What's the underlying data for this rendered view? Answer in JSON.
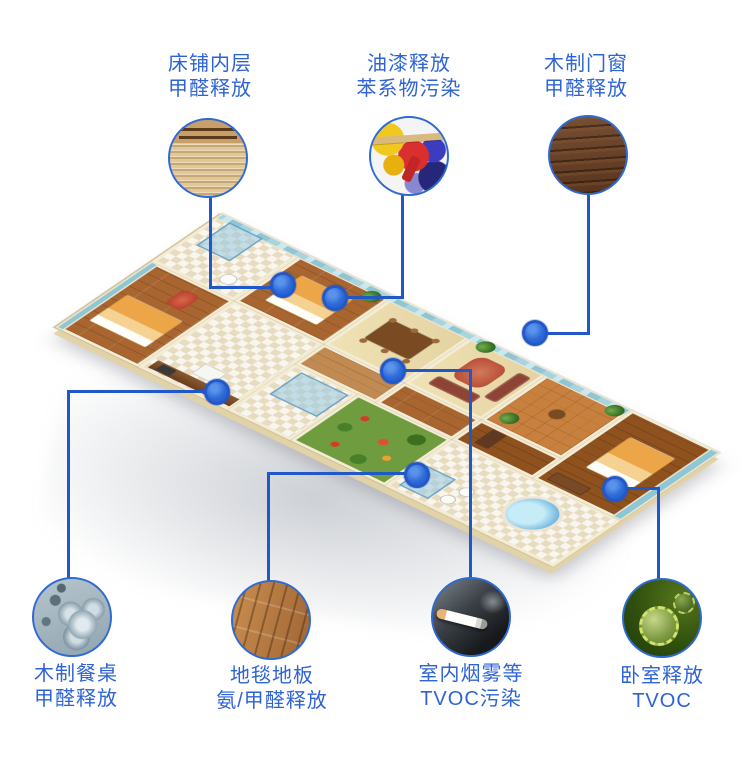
{
  "diagram": {
    "subject": "3d-apartment-indoor-air-pollution-sources",
    "colors": {
      "label_text": "#2e63d6",
      "connector_line": "#2058c8",
      "hotspot_dot": "#2e6bd8",
      "circle_border": "#2f6ad2",
      "background": "#ffffff"
    }
  },
  "callouts": [
    {
      "id": "bed-inner-layer",
      "line1": "床铺内层",
      "line2": "甲醛释放",
      "thumb": "bed-slats-photo"
    },
    {
      "id": "paint-release",
      "line1": "油漆释放",
      "line2": "苯系物污染",
      "thumb": "paint-cans-photo"
    },
    {
      "id": "wooden-doors-windows",
      "line1": "木制门窗",
      "line2": "甲醛释放",
      "thumb": "dark-wood-grain-photo"
    },
    {
      "id": "wooden-dining-table",
      "line1": "木制餐桌",
      "line2": "甲醛释放",
      "thumb": "molecule-spheres-photo"
    },
    {
      "id": "carpet-floor",
      "line1": "地毯地板",
      "line2": "氨/甲醛释放",
      "thumb": "wood-floor-photo"
    },
    {
      "id": "indoor-smoke",
      "line1": "室内烟雾等",
      "line2": "TVOC污染",
      "thumb": "cigarette-photo"
    },
    {
      "id": "bedroom-release",
      "line1": "卧室释放",
      "line2": "TVOC",
      "thumb": "green-virus-photo"
    }
  ]
}
